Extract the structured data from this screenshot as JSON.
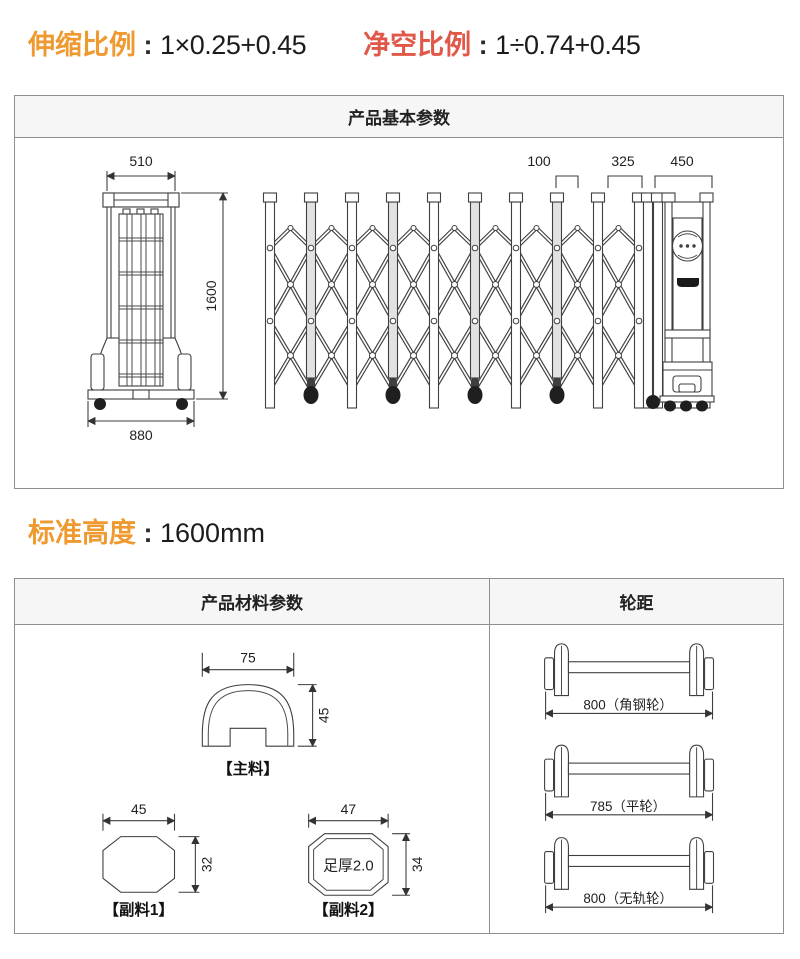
{
  "top_ratios": {
    "separator": " : ",
    "extension": {
      "label": "伸缩比例",
      "value": "1×0.25+0.45"
    },
    "clearance": {
      "label": "净空比例",
      "value": "1÷0.74+0.45"
    }
  },
  "basic_box": {
    "title": "产品基本参数",
    "folded_view": {
      "top_width": "510",
      "base_width": "880",
      "height": "1600"
    },
    "expanded_view": {
      "pitch": "100",
      "fold_depth": "325",
      "head_width": "450"
    }
  },
  "standard_height": {
    "label": "标准高度",
    "separator": " : ",
    "value": "1600mm"
  },
  "material_box": {
    "title": "产品材料参数",
    "main_profile": {
      "width": "75",
      "height": "45",
      "caption": "【主料】"
    },
    "sub_profile_1": {
      "width": "45",
      "height": "32",
      "caption": "【副料1】"
    },
    "sub_profile_2": {
      "width": "47",
      "height": "34",
      "caption": "【副料2】",
      "wall_note": "足厚2.0"
    }
  },
  "wheel_box": {
    "title": "轮距",
    "tracks": [
      {
        "label": "800（角钢轮）"
      },
      {
        "label": "785（平轮）"
      },
      {
        "label": "800（无轨轮）"
      }
    ]
  },
  "colors": {
    "accent_orange": "#ef9a30",
    "accent_red": "#e05848",
    "line": "#3f3f3f"
  }
}
